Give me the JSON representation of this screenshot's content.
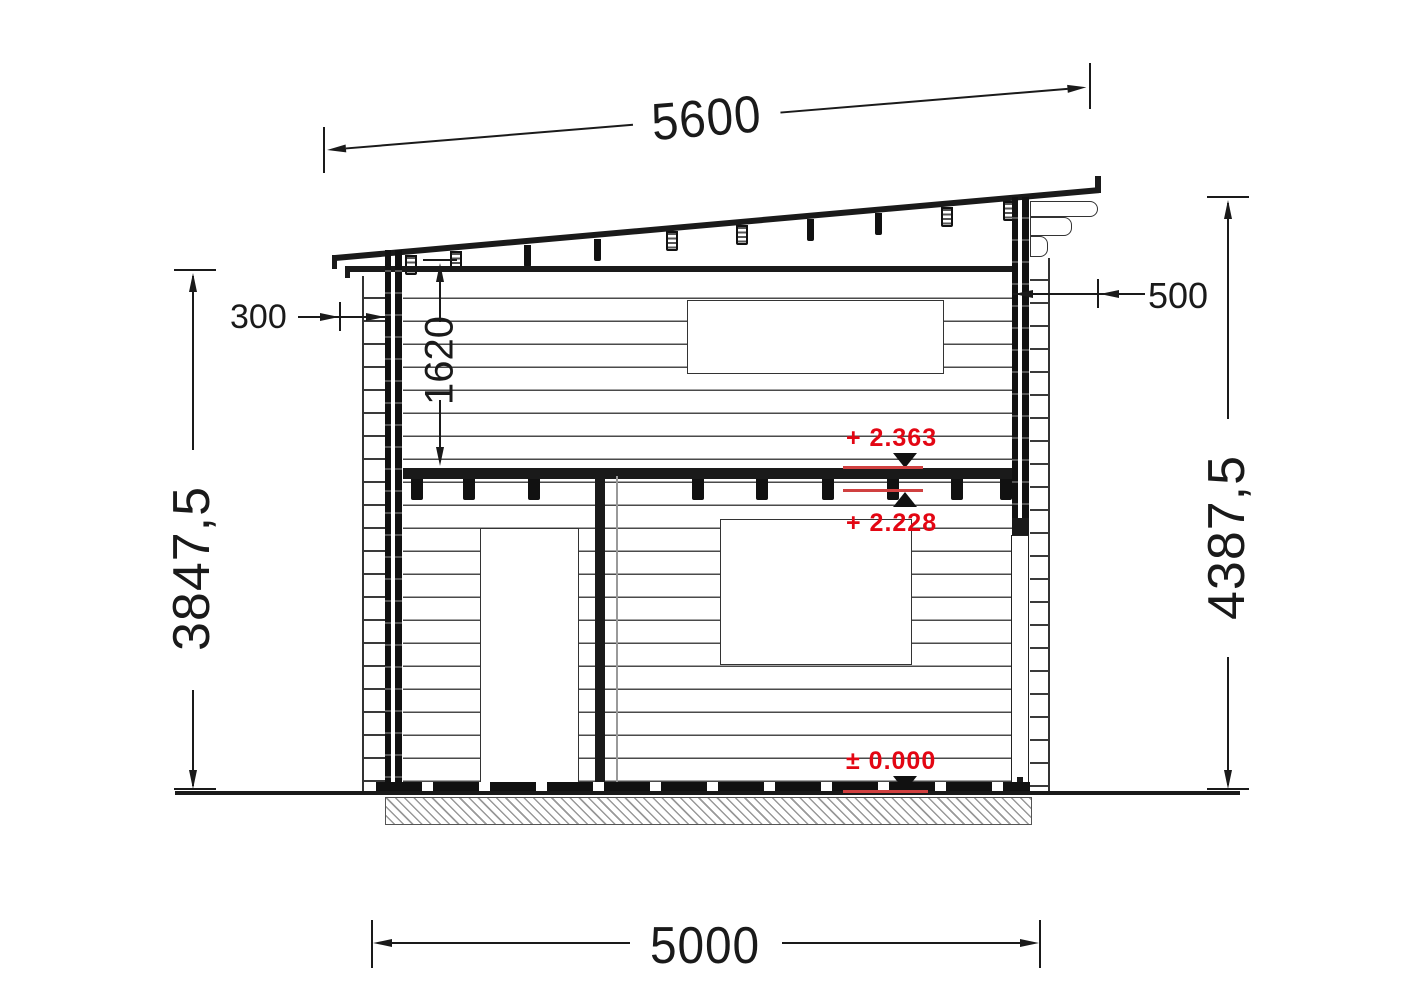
{
  "drawing": {
    "type": "cabin side elevation, technical CAD drawing",
    "dimensions": {
      "roof_length": "5600",
      "left_overhang": "300",
      "right_overhang": "500",
      "loft_height": "1620",
      "height_left": "3847,5",
      "height_right": "4387,5",
      "base_width": "5000"
    },
    "levels": {
      "loft_top": "+ 2.363",
      "loft_bottom": "+ 2.228",
      "ground": "± 0.000"
    },
    "colors": {
      "annotation_red": "#e30613",
      "drawing_black": "#1a1a1a",
      "background": "#ffffff"
    }
  }
}
